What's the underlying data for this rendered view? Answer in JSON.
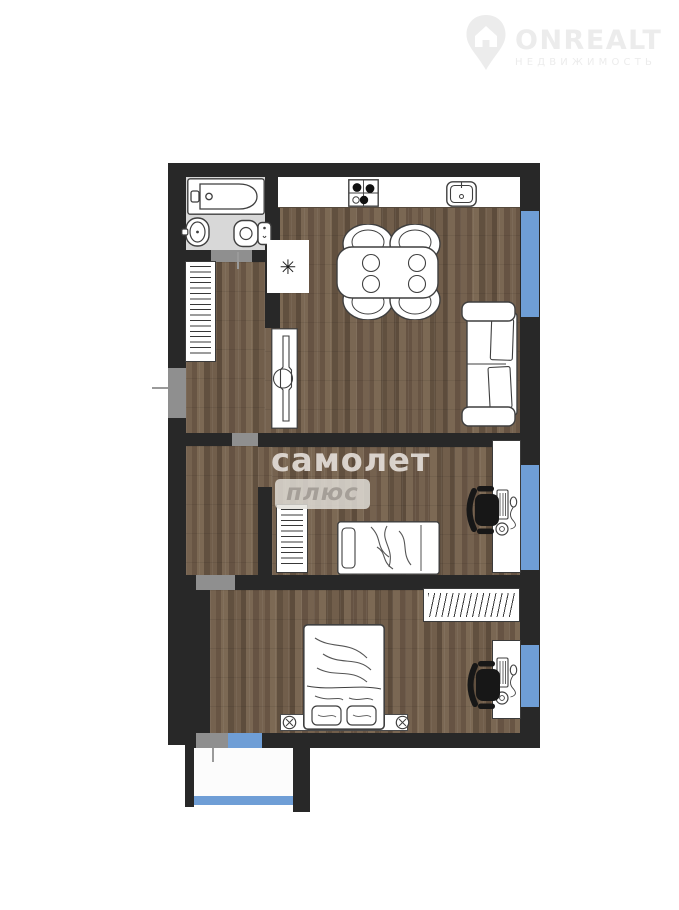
{
  "brand": {
    "name": "ONREALT",
    "tagline": "НЕДВИЖИМОСТЬ"
  },
  "watermark": {
    "primary": "самолет",
    "secondary": "плюс"
  },
  "symbols": {
    "fridge": "✳"
  },
  "colors": {
    "wall": "#282828",
    "window": "#6f9ed6",
    "doorway": "#8f8f8f",
    "wood": "#6d5a48",
    "bath_floor": "#d8d8d8",
    "logo": "#ececec",
    "watermark_text": "#ece8e3"
  },
  "furniture_items": [
    "bathtub",
    "washbasin",
    "toilet",
    "stove",
    "kitchen-sink",
    "fridge-niche",
    "dining-table",
    "dining-chairs",
    "sofa",
    "hall-wardrobe",
    "sliding-door",
    "middle-wardrobe",
    "single-bed",
    "double-bed",
    "bottom-wardrobe",
    "desk",
    "office-chair",
    "windows",
    "balcony"
  ]
}
